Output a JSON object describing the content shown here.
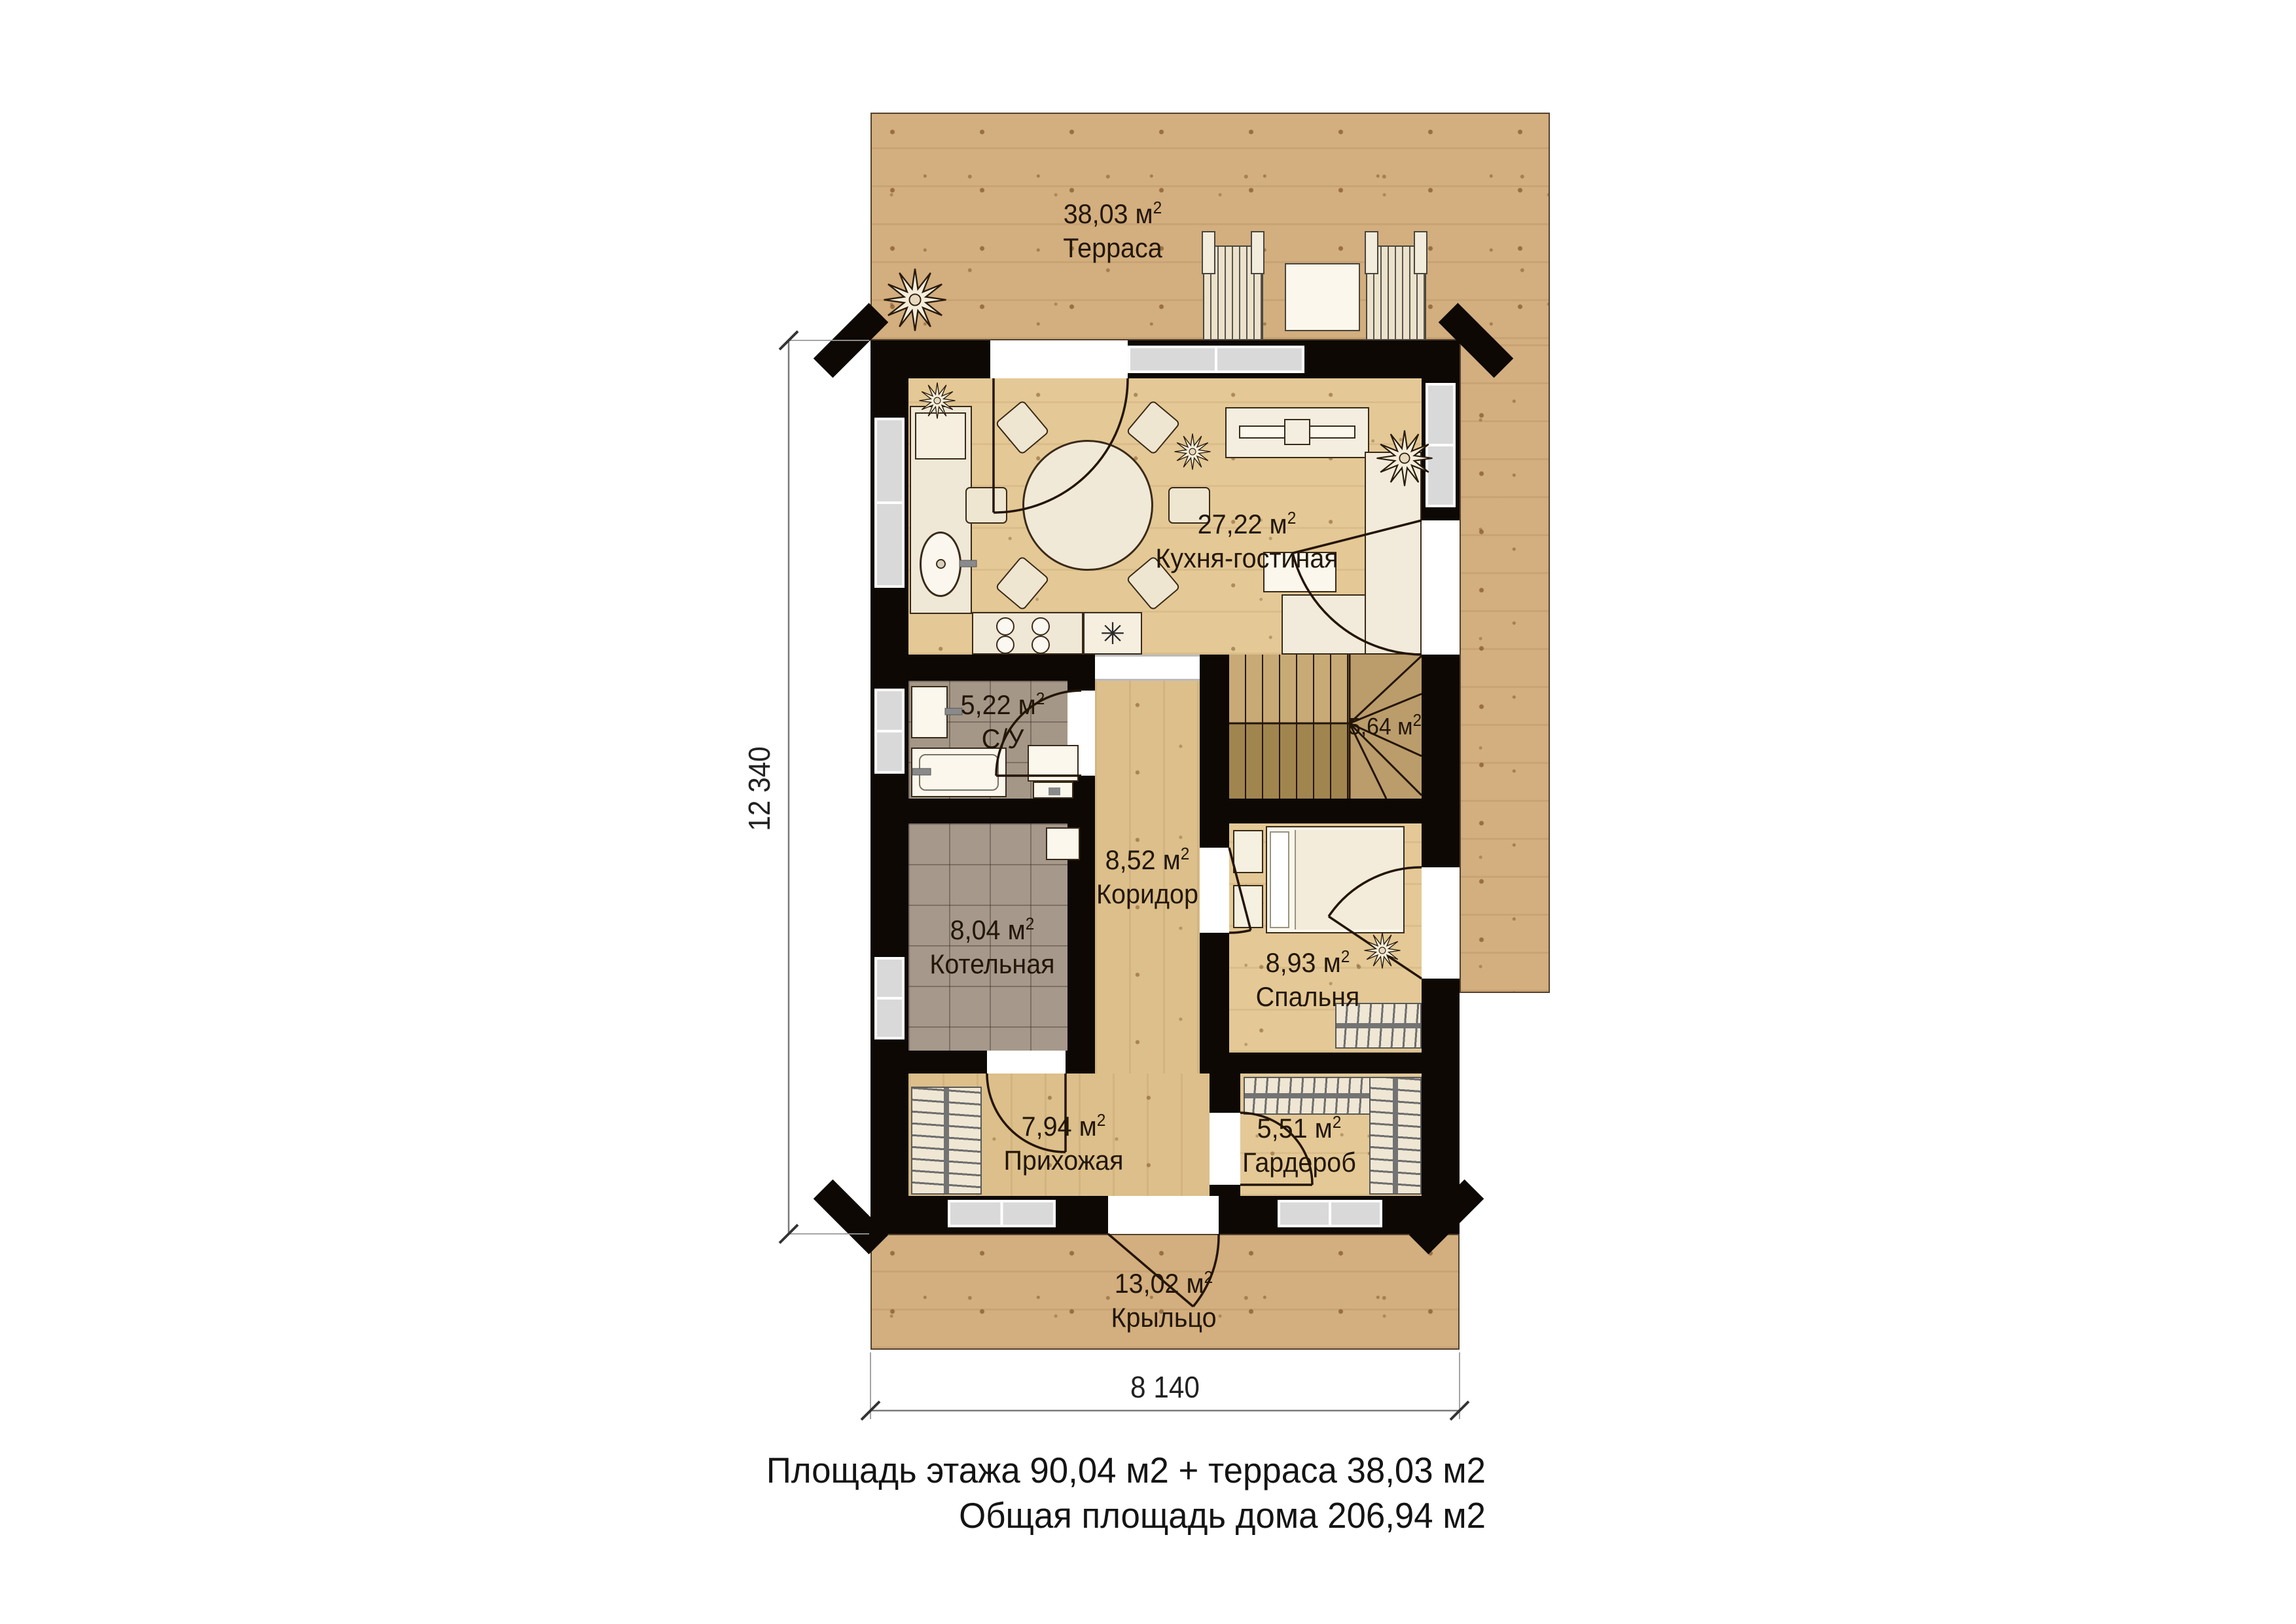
{
  "labels": {
    "unit": "м",
    "sup": "2"
  },
  "rooms": {
    "terrace": {
      "area": "38,03",
      "name": "Терраса"
    },
    "kitchen": {
      "area": "27,22",
      "name": "Кухня-гостиная"
    },
    "bathroom": {
      "area": "5,22",
      "name": "С/У"
    },
    "stairs": {
      "area": "5,64",
      "name": ""
    },
    "corridor": {
      "area": "8,52",
      "name": "Коридор"
    },
    "boiler": {
      "area": "8,04",
      "name": "Котельная"
    },
    "bedroom": {
      "area": "8,93",
      "name": "Спальня"
    },
    "hallway": {
      "area": "7,94",
      "name": "Прихожая"
    },
    "wardrobe": {
      "area": "5,51",
      "name": "Гардероб"
    },
    "porch": {
      "area": "13,02",
      "name": "Крыльцо"
    }
  },
  "dimensions": {
    "height": "12 340",
    "width": "8 140"
  },
  "footer": {
    "line1": "Площадь этажа 90,04 м2 + терраса 38,03 м2",
    "line2": "Общая площадь дома 206,94 м2"
  },
  "icons": {
    "snowflake": "✳"
  },
  "colors": {
    "wall": "#0d0804",
    "deck": "#d3ae7e",
    "floor": "#e4c996",
    "tile": "#a6988a"
  }
}
